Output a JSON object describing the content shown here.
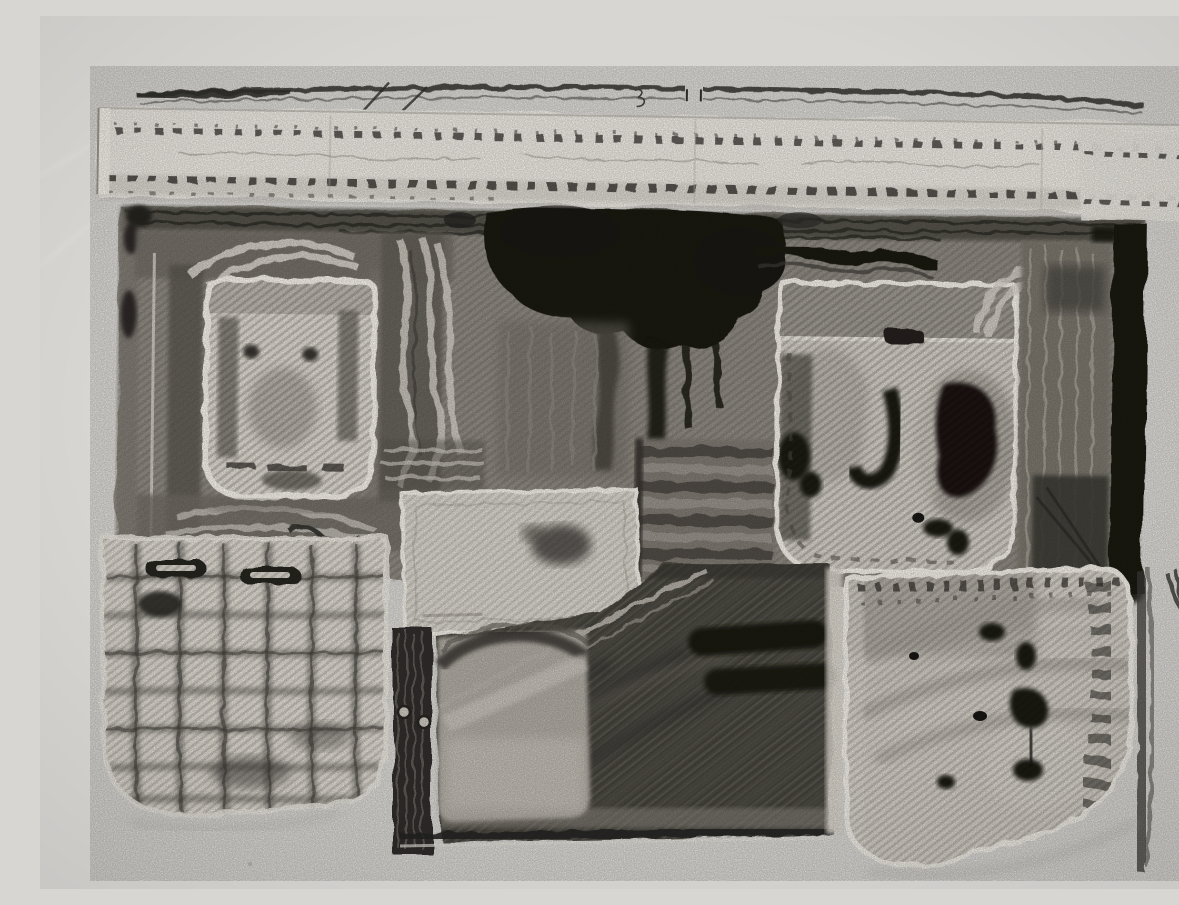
{
  "scene": {
    "title": "Denim monoprint artwork",
    "description": "Photograph of a black-and-white abstract monotype print on white paper, made by inking parts of denim jeans: a stitched waistband across the top, pocket shapes, a plaid-textured pocket, a dark denim leg panel with rivets and seams, and heavy black ink blotches",
    "medium": "ink monoprint on paper",
    "style": "abstract monochrome",
    "orientation": "landscape"
  },
  "palette": {
    "paper": "#d8d6d3",
    "paper_shade": "#c7c6c3",
    "band_white": "#eae7e1",
    "print_gray": "#8e8a82",
    "frame_dark": "#474440",
    "pocket_bright": "#dedad2",
    "pocket_soft": "#d4d0c8",
    "patch_white": "#d9d6ce",
    "denim_dark": "#4a4741",
    "ink_black": "#161411",
    "stitch_dark": "#383633",
    "stain_gray": "#9b968e",
    "highlight_white": "#eeebe4"
  },
  "regions": [
    {
      "name": "paper-background",
      "label": "Light gray paper background",
      "bbox": [
        0,
        0,
        1179,
        873
      ]
    },
    {
      "name": "waistband-print",
      "label": "Jeans waistband print with two rows of dark stitch dashes and pencil slashes",
      "bbox": [
        55,
        58,
        1093,
        130
      ]
    },
    {
      "name": "main-print-block",
      "label": "Large mottled gray printed field",
      "bbox": [
        78,
        188,
        1032,
        376
      ]
    },
    {
      "name": "left-frame-print",
      "label": "Brushed dark frame print with white arcs",
      "bbox": [
        95,
        212,
        345,
        322
      ]
    },
    {
      "name": "left-pocket-print",
      "label": "Small white pocket print with two dark dots",
      "bbox": [
        165,
        260,
        172,
        232
      ]
    },
    {
      "name": "white-brushstrokes",
      "label": "Wavy white flame-like brushstrokes",
      "bbox": [
        342,
        212,
        64,
        268
      ]
    },
    {
      "name": "central-ink-mass",
      "label": "Heavy black ink mass with drips and a wavy arm",
      "bbox": [
        418,
        182,
        486,
        268
      ]
    },
    {
      "name": "striped-block",
      "label": "Horizontally striped gray block",
      "bbox": [
        598,
        414,
        140,
        142
      ]
    },
    {
      "name": "right-pocket-print",
      "label": "Large pocket print with dark stains and stitch flap",
      "bbox": [
        737,
        256,
        244,
        296
      ]
    },
    {
      "name": "scratched-column",
      "label": "Scratched gray column",
      "bbox": [
        980,
        212,
        94,
        352
      ]
    },
    {
      "name": "black-strip",
      "label": "Solid black vertical strip",
      "bbox": [
        1072,
        194,
        38,
        374
      ]
    },
    {
      "name": "white-patch-print",
      "label": "Pale rectangular patch with soft dark blotch",
      "bbox": [
        360,
        476,
        238,
        144
      ]
    },
    {
      "name": "plaid-pocket-print",
      "label": "Plaid-textured pocket print with buttonhole slots",
      "bbox": [
        62,
        520,
        286,
        286
      ]
    },
    {
      "name": "denim-leg-print",
      "label": "Dark denim leg print with diagonal seam, rivets and black dashes",
      "bbox": [
        352,
        546,
        450,
        290
      ]
    },
    {
      "name": "bottom-right-pocket-print",
      "label": "Large pocket print with ladder stitch ticks and black ink spots",
      "bbox": [
        804,
        548,
        336,
        312
      ]
    }
  ]
}
